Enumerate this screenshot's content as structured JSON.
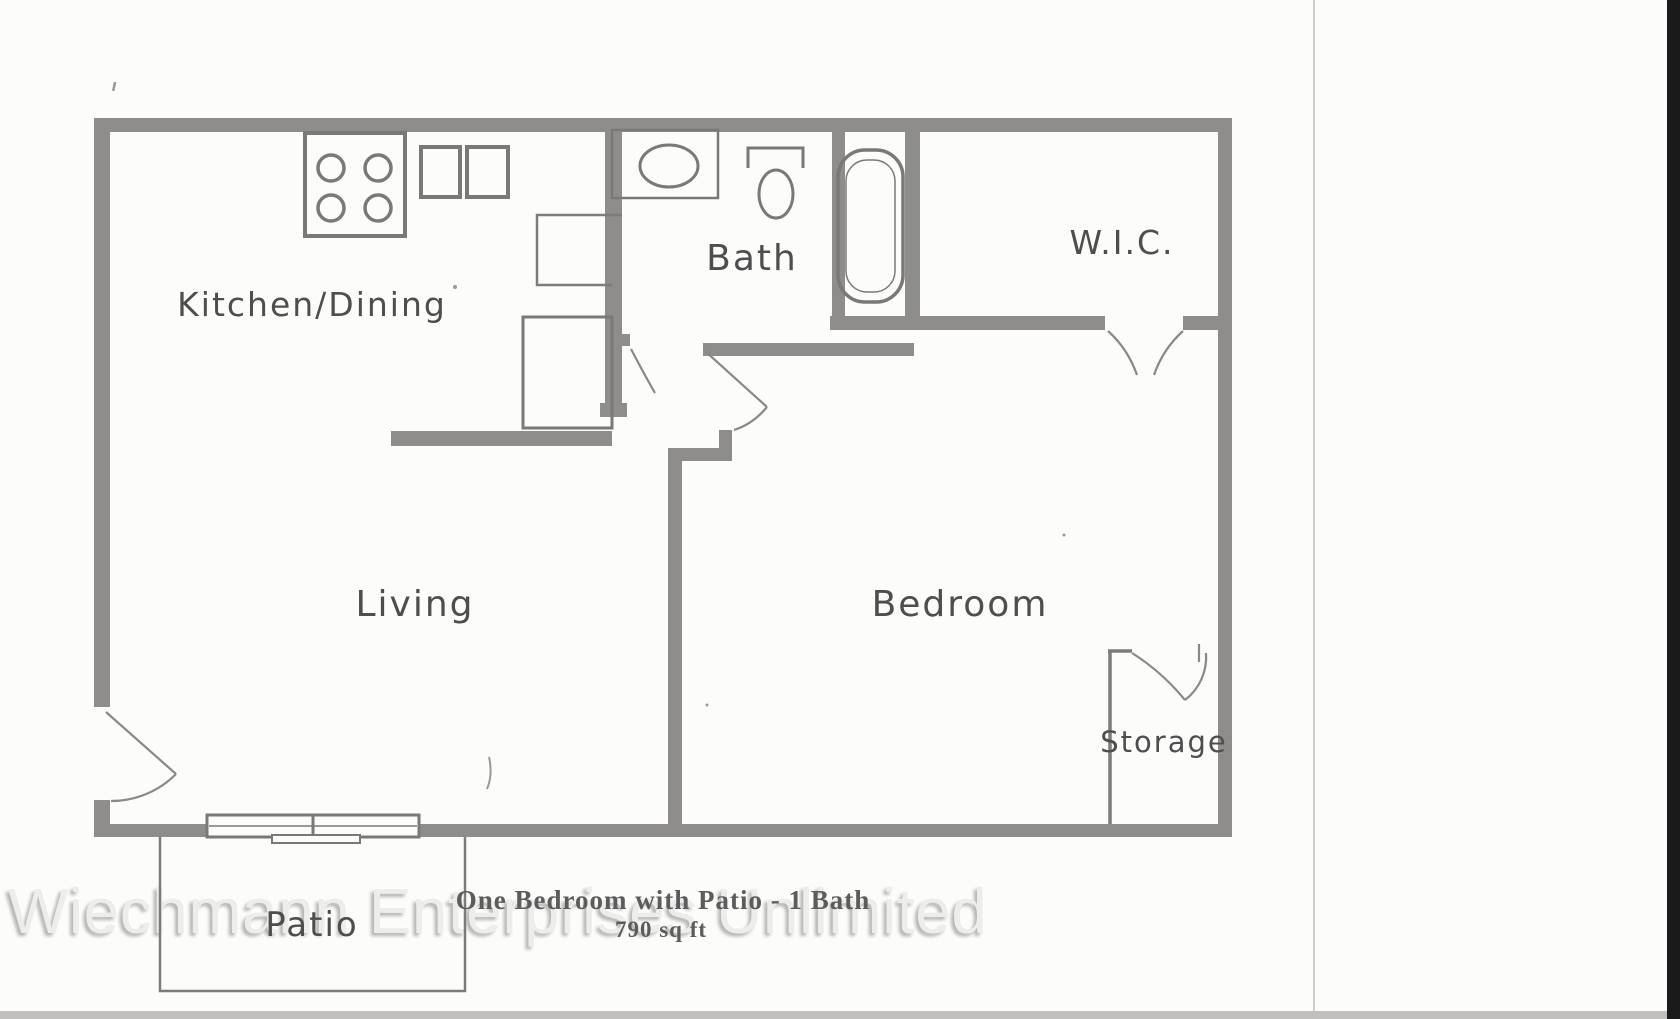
{
  "page": {
    "background_color": "#fcfcfa",
    "scan_edge_x": 1313,
    "right_strip_color": "#1a1a1a",
    "bottom_strip_color": "#c1c0bd"
  },
  "watermark": {
    "text": "Wiechmann Enterprises Unlimited",
    "color": "#ededec"
  },
  "caption": {
    "line1": "One Bedroom with Patio - 1 Bath",
    "line2": "790 sq ft"
  },
  "rooms": {
    "kitchen_dining": "Kitchen/Dining",
    "bath": "Bath",
    "wic": "W.I.C.",
    "living": "Living",
    "bedroom": "Bedroom",
    "storage": "Storage",
    "patio": "Patio"
  },
  "colors": {
    "wall": "#8e8d8b",
    "thin_line": "#7d7c7a",
    "fixture": "#7a7977",
    "door_arc": "#8a8987",
    "label_text": "#4e4e4e",
    "caption_text": "#5c5c5c"
  }
}
